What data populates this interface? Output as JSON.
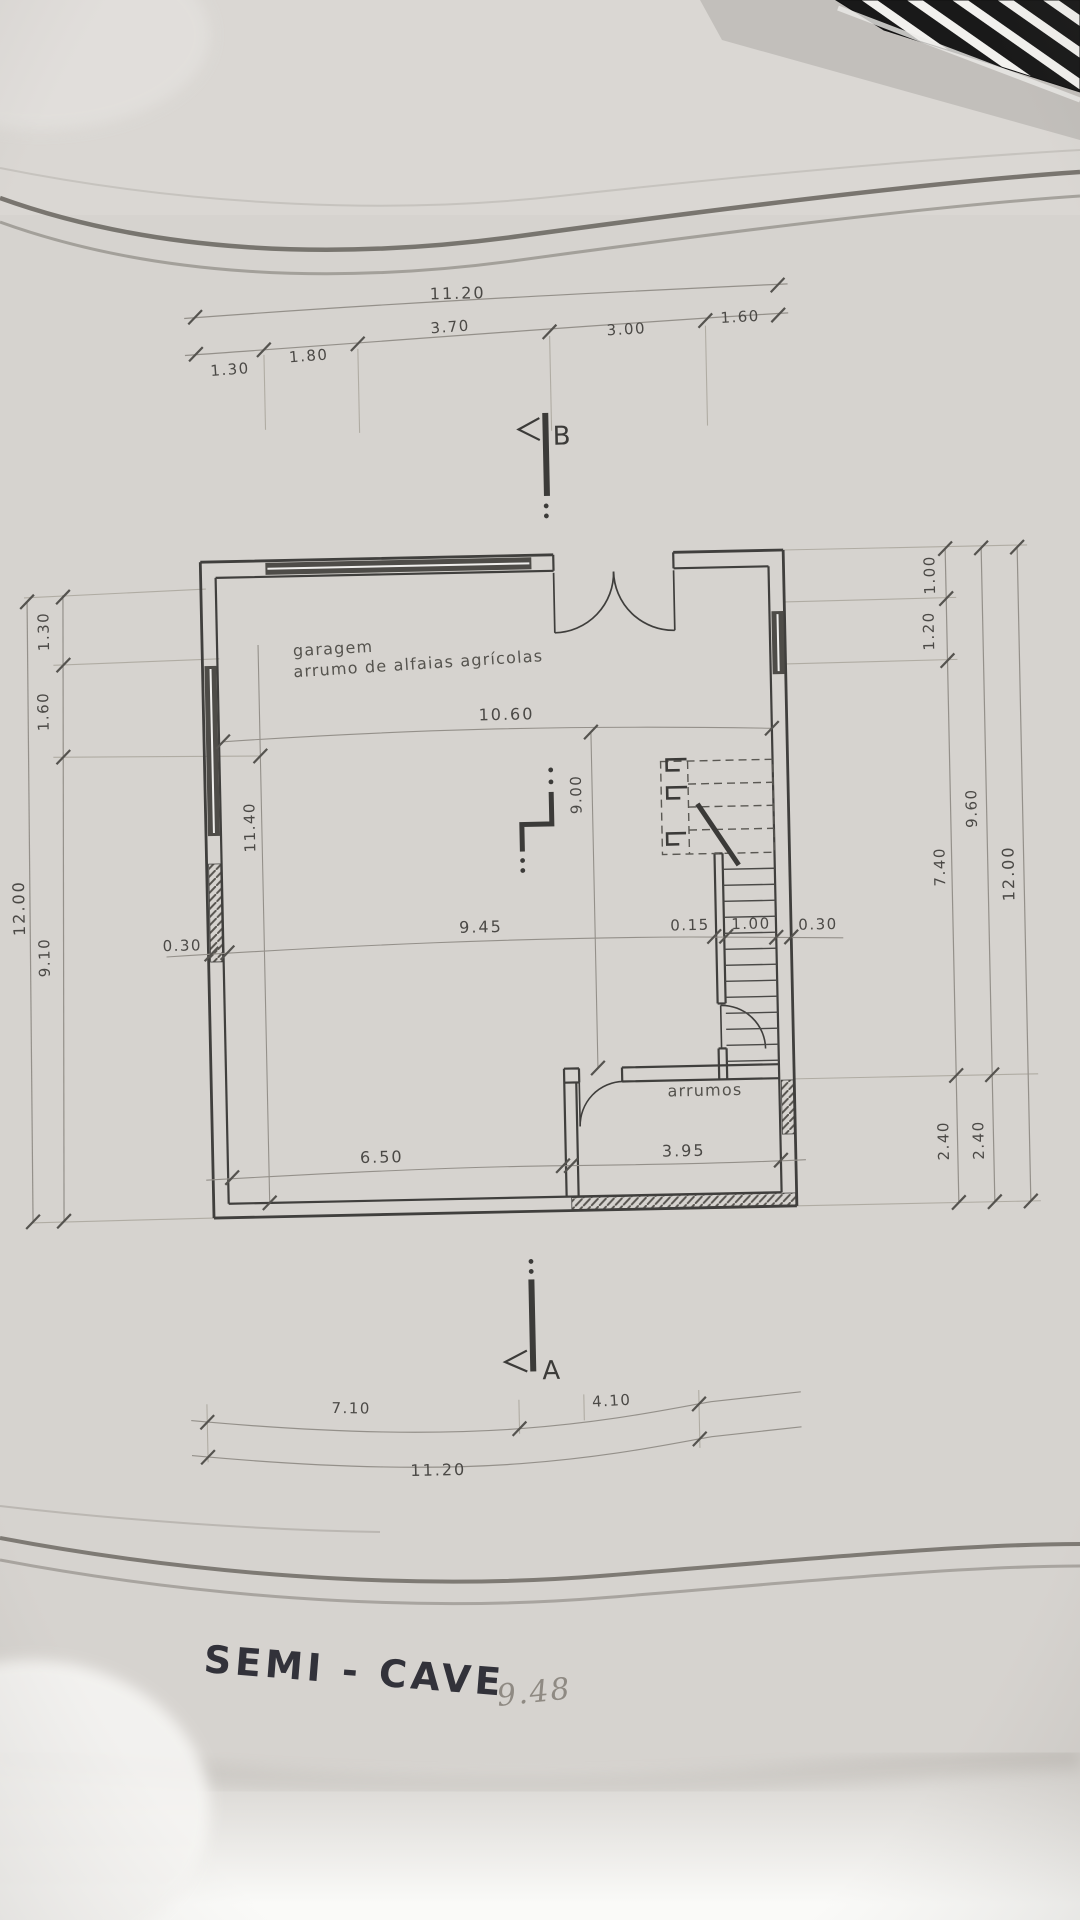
{
  "plan": {
    "title": "SEMI - CAVE",
    "note_pencil": "9.48",
    "rooms": {
      "garage_line1": "garagem",
      "garage_line2": "arrumo de alfaias agrícolas",
      "storage": "arrumos"
    },
    "sections": {
      "a": "A",
      "b": "B"
    },
    "dims": {
      "top_total": "11.20",
      "top_seg1": "1.30",
      "top_seg2": "1.80",
      "top_seg3": "3.70",
      "top_seg4": "3.00",
      "top_seg5": "1.60",
      "bottom_seg1": "7.10",
      "bottom_seg2": "4.10",
      "bottom_total": "11.20",
      "left_seg1": "1.30",
      "left_seg2": "1.60",
      "left_seg3": "9.10",
      "left_total": "12.00",
      "right_seg1": "1.00",
      "right_seg2": "1.20",
      "right_seg3": "7.40",
      "right_seg4": "2.40",
      "right_mid1": "9.60",
      "right_mid2": "2.40",
      "right_total": "12.00",
      "inner_width": "10.60",
      "inner_row_wall_left": "0.30",
      "inner_row_width": "9.45",
      "inner_row_wall_mid": "0.15",
      "inner_row_stair": "1.00",
      "inner_row_wall_right": "0.30",
      "inner_height_left": "11.40",
      "inner_height_right": "9.00",
      "room_width_garage": "6.50",
      "room_width_storage": "3.95"
    }
  },
  "colors": {
    "paper": "#d6d3cf",
    "ink": "#3f3e3c",
    "dim_line": "#94908a",
    "label": "#4b4946",
    "title_ink": "#32323a",
    "pencil": "#8f8a83",
    "crease": "#6e6a64",
    "ruler_black": "#191919",
    "ruler_white": "#f2f1ee"
  }
}
